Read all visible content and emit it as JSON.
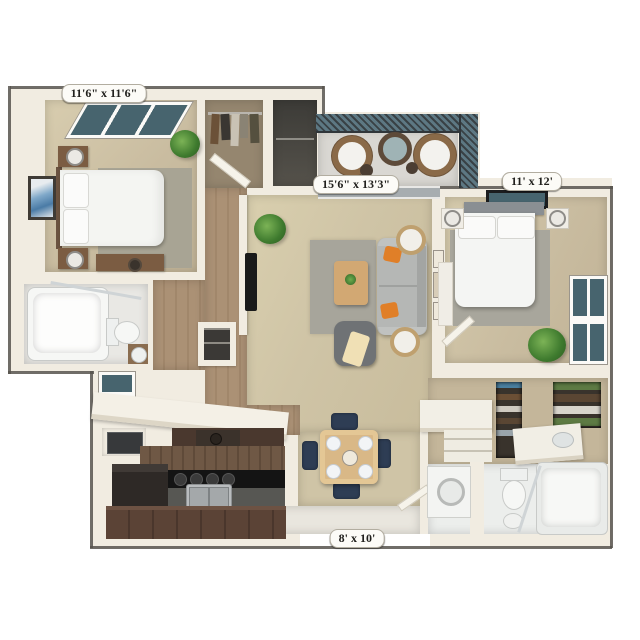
{
  "image": {
    "type": "3d-top-down-apartment-floor-plan",
    "background": "#ffffff"
  },
  "labels": {
    "bedroom1": "11'6\" x 11'6\"",
    "living": "15'6\" x 13'3\"",
    "bedroom2": "11' x 12'",
    "kitchen": "8' x 10'"
  },
  "palette": {
    "wall_cream": "#f1ece1",
    "window_teal": "#47646e",
    "carpet_living": "#cfc4a6",
    "carpet_bedroom": "#c9bca0",
    "wood_hall": "#ab9175",
    "closet_floor": "#95866f",
    "kitchen_cabinet_brown": "#5b4336",
    "countertop_black": "#141414",
    "rug_gray": "#a7a59b",
    "sofa_gray": "#b5b7b5",
    "pillow_orange": "#e07f28",
    "dining_table_wood": "#d9b887",
    "chair_navy": "#2e3d54",
    "balcony_mesh": "#394145",
    "tile_bath": "#e9e8e4",
    "plant_green": "#3e7a2e"
  }
}
